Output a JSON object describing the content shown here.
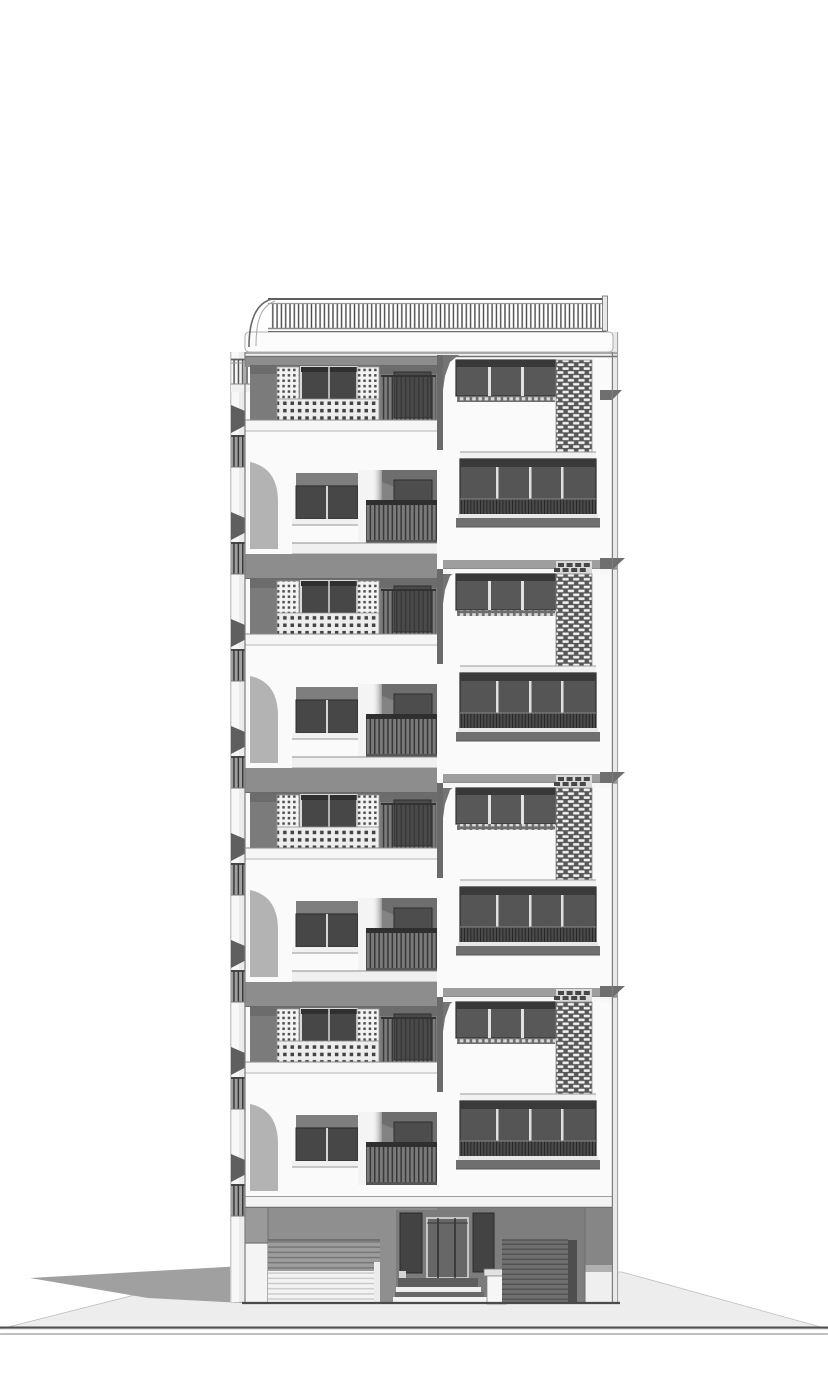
{
  "scene": {
    "kind": "architectural-elevation-render",
    "description": "Grayscale 3D rendered front elevation of a multi-storey residential tower with balconies, perforated lattice screens, a vertical jali brick screen, roof railing, ground-floor garages and central entrance steps."
  },
  "canvas": {
    "width": 828,
    "height": 1393
  },
  "palette": {
    "page": "#ffffff",
    "wall": "#fafafa",
    "wallShadow": "#ececec",
    "cornerShade": "#b3b3b3",
    "slabLight": "#f0f0f0",
    "slabGray": "#9e9e9e",
    "slabDark": "#6f6f6f",
    "canopy": "#8d8d8d",
    "recess": "#7b7b7b",
    "recessDark": "#6c6c6c",
    "recess2": "#838383",
    "glass": "#585858",
    "glassDark": "#474747",
    "glassDeep": "#3a3a3a",
    "frameDark": "#2d2d2d",
    "frameLight": "#d9d9d9",
    "mullion": "#e2e2e2",
    "lattice": "#f3f3f3",
    "latticeHole": "#4e4e4e",
    "jaliBg": "#575757",
    "jaliBrick": "#f2f2f2",
    "railDark": "#2f2f2f",
    "railBar": "#383838",
    "railBg": "#7a7a7a",
    "stripShade": "#9f9f9f",
    "awning": "#5f5f5f",
    "groundWallLeft": "#8f8f8f",
    "groundWallRight": "#7e7e7e",
    "entranceBay": "#7c7c7c",
    "doorPanel": "#434343",
    "doorLeaf": "#676767",
    "shutterGrayBg": "#9d9d9d",
    "shutterGrayLine": "#747474",
    "shutterWhiteBg": "#f3f3f3",
    "shutterWhiteLine": "#c9c9c9",
    "shutterDarkBg": "#6f6f6f",
    "shutterDarkLine": "#4e4e4e",
    "pavement": "#ededed",
    "castShadow": "#a0a0a0",
    "groundLine": "#4f4f4f",
    "outline": "#7d7d7d",
    "ventBg": "#d9d9d9",
    "ventBrick": "#474747",
    "pierWhite": "#f4f4f4"
  },
  "building": {
    "left": 245,
    "right": 612,
    "side_return_right": 618,
    "strip_left": 230,
    "notch": {
      "left": 437,
      "right": 443
    },
    "floor_slab_y": [
      352,
      566,
      780,
      994
    ],
    "floor_pitch": 214,
    "ground": {
      "slab_top": 1196,
      "wall_top": 1208,
      "base": 1302
    },
    "roof": {
      "rail_left": 270,
      "rail_right": 604,
      "rail_top": 296,
      "parapet_top": 332,
      "parapet_bottom": 352,
      "cornice_bottom": 357
    },
    "left_edge_balconies": {
      "count": 8,
      "first_y": 405,
      "pitch": 107
    },
    "pavement": {
      "edge_y_at_building": 1272,
      "line_y": 1327,
      "line2_y": 1334
    }
  },
  "counts": {
    "residential_floors": 4,
    "lattice_balconies": 4,
    "jali_screen_strips": 4,
    "window_bands_right_column": 8,
    "garage_shutters": 2,
    "entry_steps": 3
  }
}
